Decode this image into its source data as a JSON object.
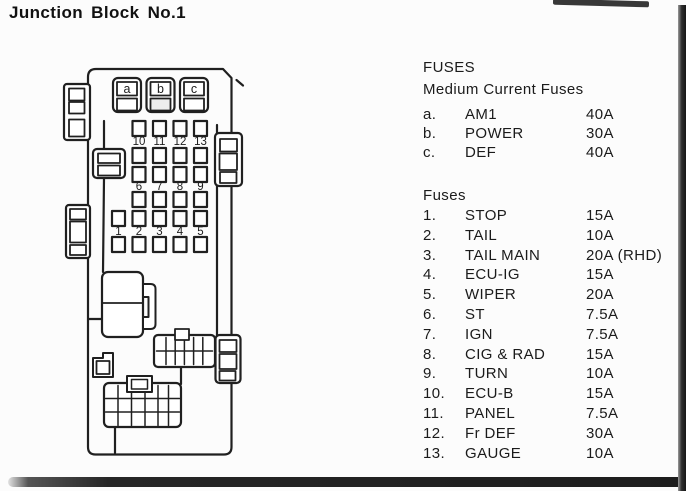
{
  "title": "Junction Block No.1",
  "diagram": {
    "medium_fuse_labels": [
      "a",
      "b",
      "c"
    ],
    "fuse_row_top": [
      "10",
      "11",
      "12",
      "13"
    ],
    "fuse_row_mid": [
      "6",
      "7",
      "8",
      "9"
    ],
    "fuse_row_bottom": [
      "1",
      "2",
      "3",
      "4",
      "5"
    ]
  },
  "panel": {
    "heading": "FUSES",
    "medium": {
      "title": "Medium Current Fuses",
      "rows": [
        {
          "id": "a.",
          "name": "AM1",
          "amp": "40A"
        },
        {
          "id": "b.",
          "name": "POWER",
          "amp": "30A"
        },
        {
          "id": "c.",
          "name": "DEF",
          "amp": "40A"
        }
      ]
    },
    "fuses": {
      "title": "Fuses",
      "rows": [
        {
          "id": "1.",
          "name": "STOP",
          "amp": "15A"
        },
        {
          "id": "2.",
          "name": "TAIL",
          "amp": "10A"
        },
        {
          "id": "3.",
          "name": "TAIL MAIN",
          "amp": "20A (RHD)"
        },
        {
          "id": "4.",
          "name": "ECU-IG",
          "amp": "15A"
        },
        {
          "id": "5.",
          "name": "WIPER",
          "amp": "20A"
        },
        {
          "id": "6.",
          "name": "ST",
          "amp": "7.5A"
        },
        {
          "id": "7.",
          "name": "IGN",
          "amp": "7.5A"
        },
        {
          "id": "8.",
          "name": "CIG & RAD",
          "amp": "15A"
        },
        {
          "id": "9.",
          "name": "TURN",
          "amp": "10A"
        },
        {
          "id": "10.",
          "name": "ECU-B",
          "amp": "15A"
        },
        {
          "id": "11.",
          "name": "PANEL",
          "amp": "7.5A"
        },
        {
          "id": "12.",
          "name": "Fr DEF",
          "amp": "30A"
        },
        {
          "id": "13.",
          "name": "GAUGE",
          "amp": "10A"
        }
      ]
    }
  }
}
